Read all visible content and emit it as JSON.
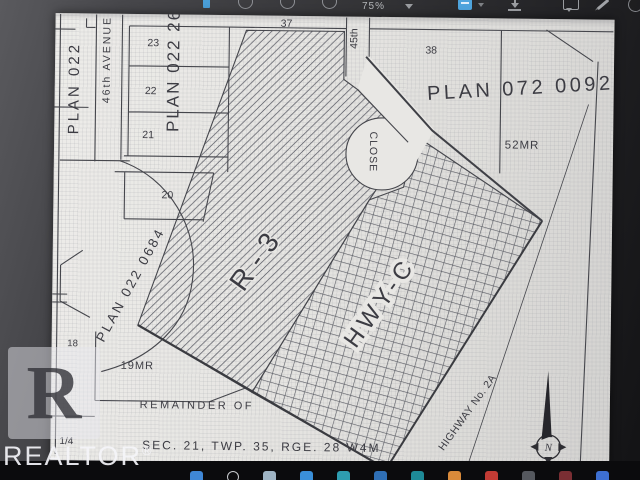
{
  "viewer": {
    "toolbar": {
      "zoom_level": "75%",
      "accent_color": "#4ea4dd"
    }
  },
  "map": {
    "labels": {
      "plan_022": "PLAN 022",
      "avenue_46th": "46th AVENUE",
      "plan_022_26": "PLAN 022 26",
      "lot_23": "23",
      "lot_22": "22",
      "lot_21": "21",
      "lot_20": "20",
      "lot_37": "37",
      "lot_38": "38",
      "lot_18": "18",
      "street_45th": "45th",
      "plan_022_0684": "PLAN 022 0684",
      "zone_r3": "R-3",
      "close": "CLOSE",
      "plan_072_0092": "PLAN 072 0092",
      "mr_52": "52MR",
      "mr_19": "19MR",
      "zone_hwy_c": "HWY-C",
      "remainder_line1": "REMAINDER OF",
      "remainder_line2": "SEC. 21, TWP. 35, RGE. 28 W4M",
      "quarter_fragment": "1/4",
      "highway": "HIGHWAY No. 2A",
      "north": "N"
    }
  },
  "watermark": {
    "letter": "R",
    "brand": "REALTOR",
    "reg": "®"
  },
  "taskbar": {
    "icons": [
      {
        "name": "start",
        "color": "#3f87d6"
      },
      {
        "name": "search",
        "color": "#c9cbce"
      },
      {
        "name": "file-explorer",
        "color": "#9fb4c4"
      },
      {
        "name": "edge-browser",
        "color": "#3a8fd9"
      },
      {
        "name": "teams",
        "color": "#2e9db0"
      },
      {
        "name": "outlook",
        "color": "#2f6fb5"
      },
      {
        "name": "app-teal",
        "color": "#1e8a97"
      },
      {
        "name": "app-orange",
        "color": "#d98a3a"
      },
      {
        "name": "app-red",
        "color": "#c23b34"
      },
      {
        "name": "app-gray",
        "color": "#55585e"
      },
      {
        "name": "app-maroon",
        "color": "#7a2e33"
      },
      {
        "name": "app-blue",
        "color": "#3d6fd1"
      }
    ]
  }
}
